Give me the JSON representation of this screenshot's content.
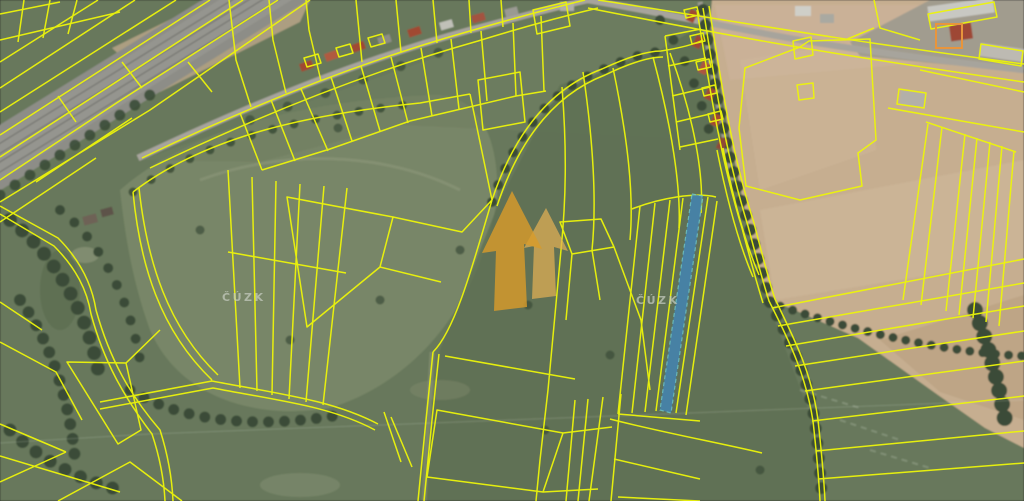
{
  "map": {
    "description": "aerial-orthophoto-with-cadastral-overlay",
    "watermarks": {
      "agency_text": "ČÚZK"
    },
    "logo": {
      "name": "double-arrow-realty-logo",
      "primary_color": "#d89b2b",
      "secondary_color": "#e2b055"
    },
    "highlighted_parcel": {
      "fill": "#4186b8",
      "points": "692,194 703,196 671,413 660,410"
    },
    "colors": {
      "parcel_line": "#edf50a",
      "parcel_line_orange": "#e8953c",
      "field_green": "#67785b",
      "meadow_light": "#7a8769",
      "forest_dark": "#3b4c37",
      "plowed_tan": "#c6ae90",
      "railway_gray": "#8d8d87",
      "road_gray": "#a7a49c",
      "roof_red": "#a04a33",
      "watermark_text_color": "#c6ccc0",
      "highlight_border": "#6ac8d0"
    }
  }
}
